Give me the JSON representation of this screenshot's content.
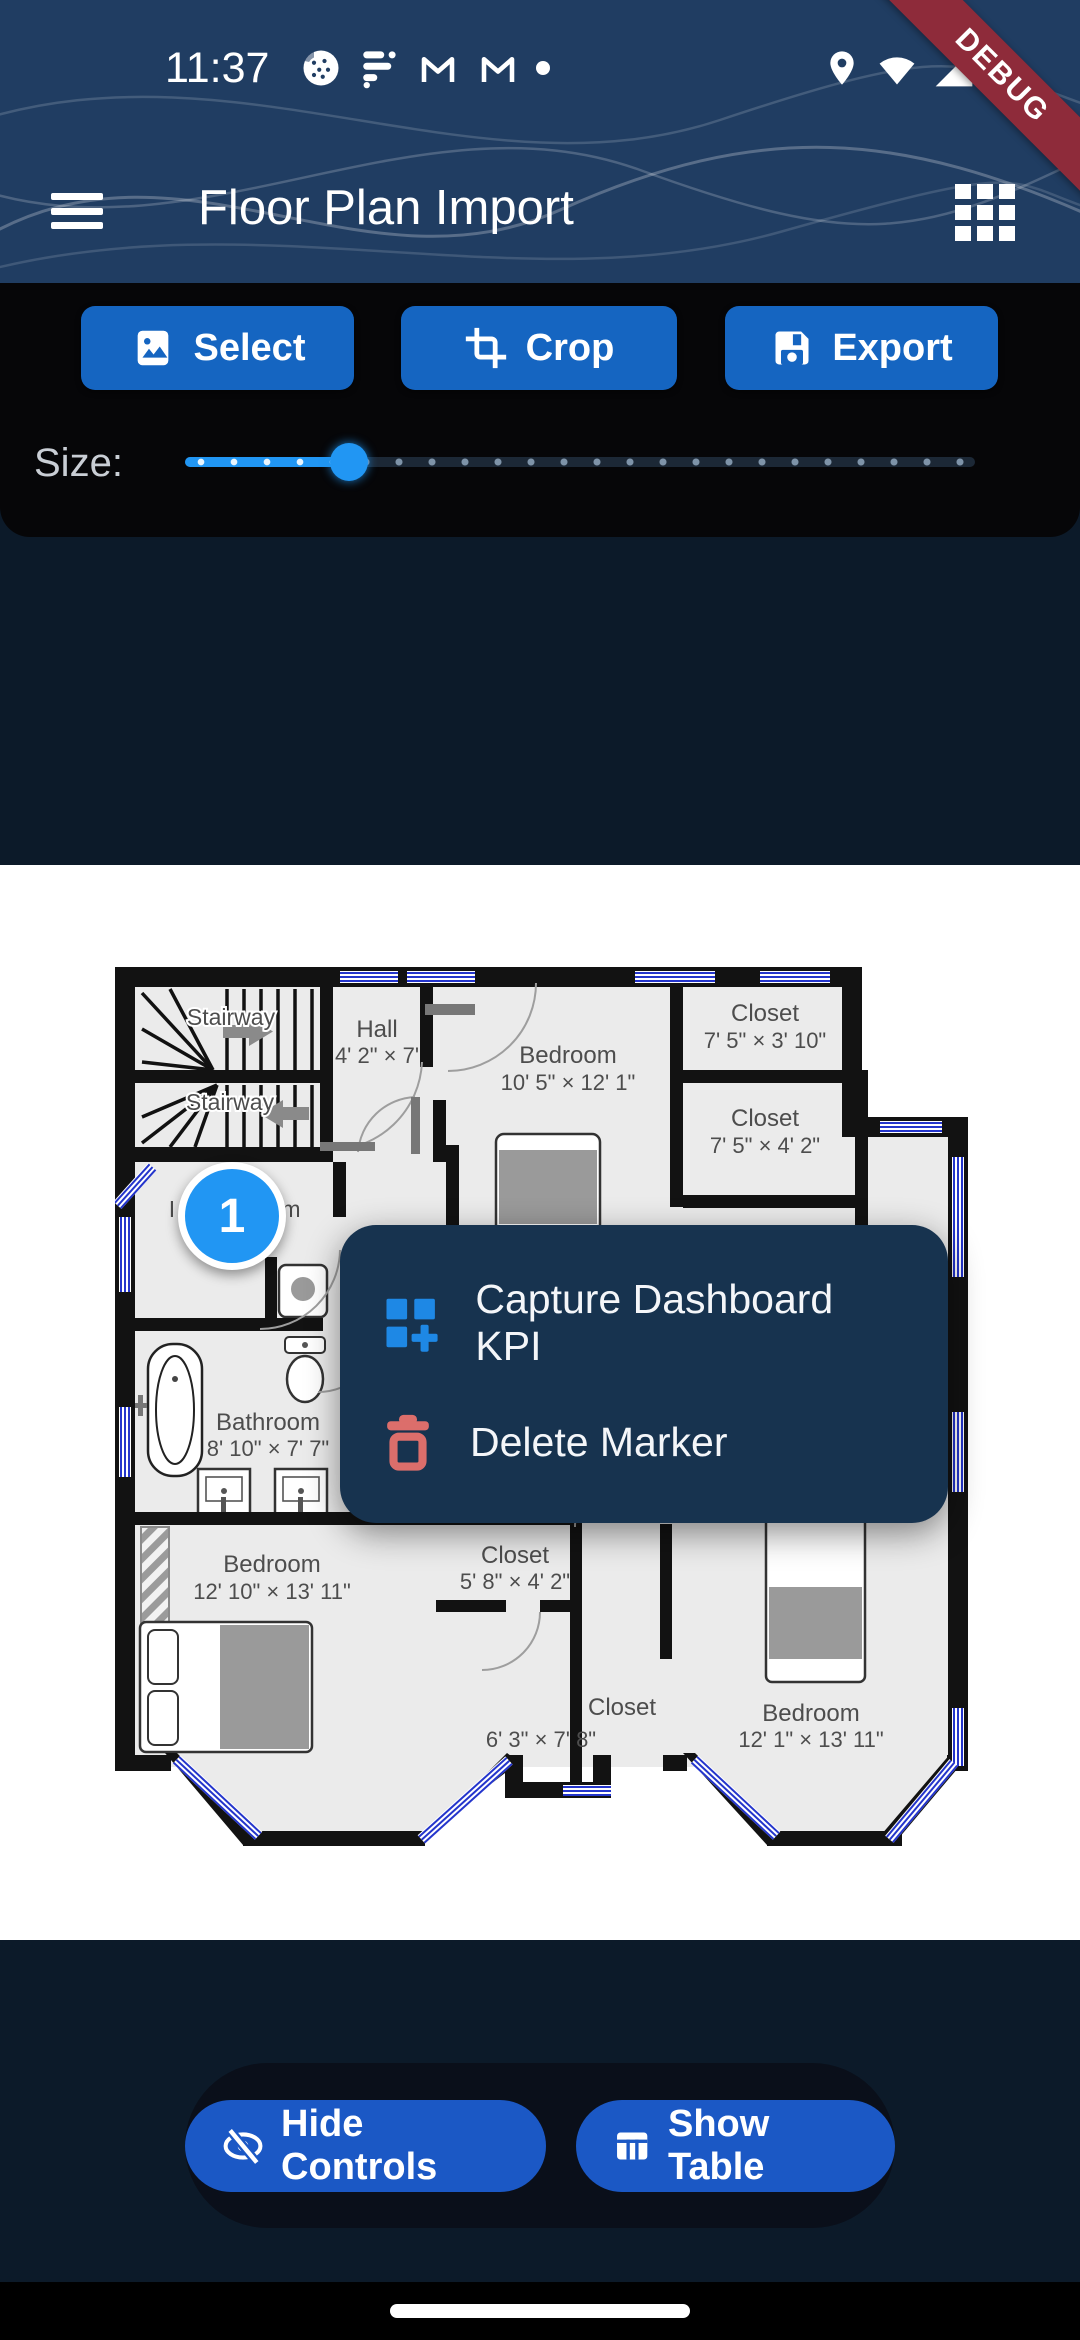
{
  "status_bar": {
    "time": "11:37"
  },
  "app_bar": {
    "title": "Floor Plan Import"
  },
  "ribbon": {
    "label": "DEBUG"
  },
  "toolbar": {
    "select_label": "Select",
    "crop_label": "Crop",
    "export_label": "Export"
  },
  "slider": {
    "label": "Size:",
    "value_fraction": 0.2
  },
  "colors": {
    "header": "#20 3D62",
    "accent_blue": "#1565C1",
    "slider_blue": "#2196F3",
    "menu_bg": "#17334F",
    "danger": "#DC6E6B",
    "ribbon_red": "#8E2B3A"
  },
  "floorplan": {
    "rooms": [
      {
        "name": "Stairway"
      },
      {
        "name": "Stairway"
      },
      {
        "name": "Hall",
        "dims": "4' 2\" × 7'"
      },
      {
        "name": "Bedroom",
        "dims": "10' 5\" × 12' 1\""
      },
      {
        "name": "Closet",
        "dims": "7' 5\" × 3' 10\""
      },
      {
        "name": "Closet",
        "dims": "7' 5\" × 4' 2\""
      },
      {
        "fragment_left": "I",
        "fragment_right": "m"
      },
      {
        "name": "Bathroom",
        "dims": "8' 10\" × 7' 7\""
      },
      {
        "name": "Bedroom",
        "dims": "12' 10\" × 13' 11\""
      },
      {
        "name": "Closet",
        "dims": "5' 8\" × 4' 2\""
      },
      {
        "dims": "6' 3\" × 7' 8\""
      },
      {
        "name": "Closet"
      },
      {
        "name": "Bedroom",
        "dims": "12' 1\" × 13' 11\""
      }
    ],
    "marker": {
      "label": "1"
    }
  },
  "context_menu": {
    "items": [
      {
        "label": "Capture Dashboard KPI"
      },
      {
        "label": "Delete Marker"
      }
    ]
  },
  "bottom_bar": {
    "hide_controls_label": "Hide Controls",
    "show_table_label": "Show Table"
  }
}
